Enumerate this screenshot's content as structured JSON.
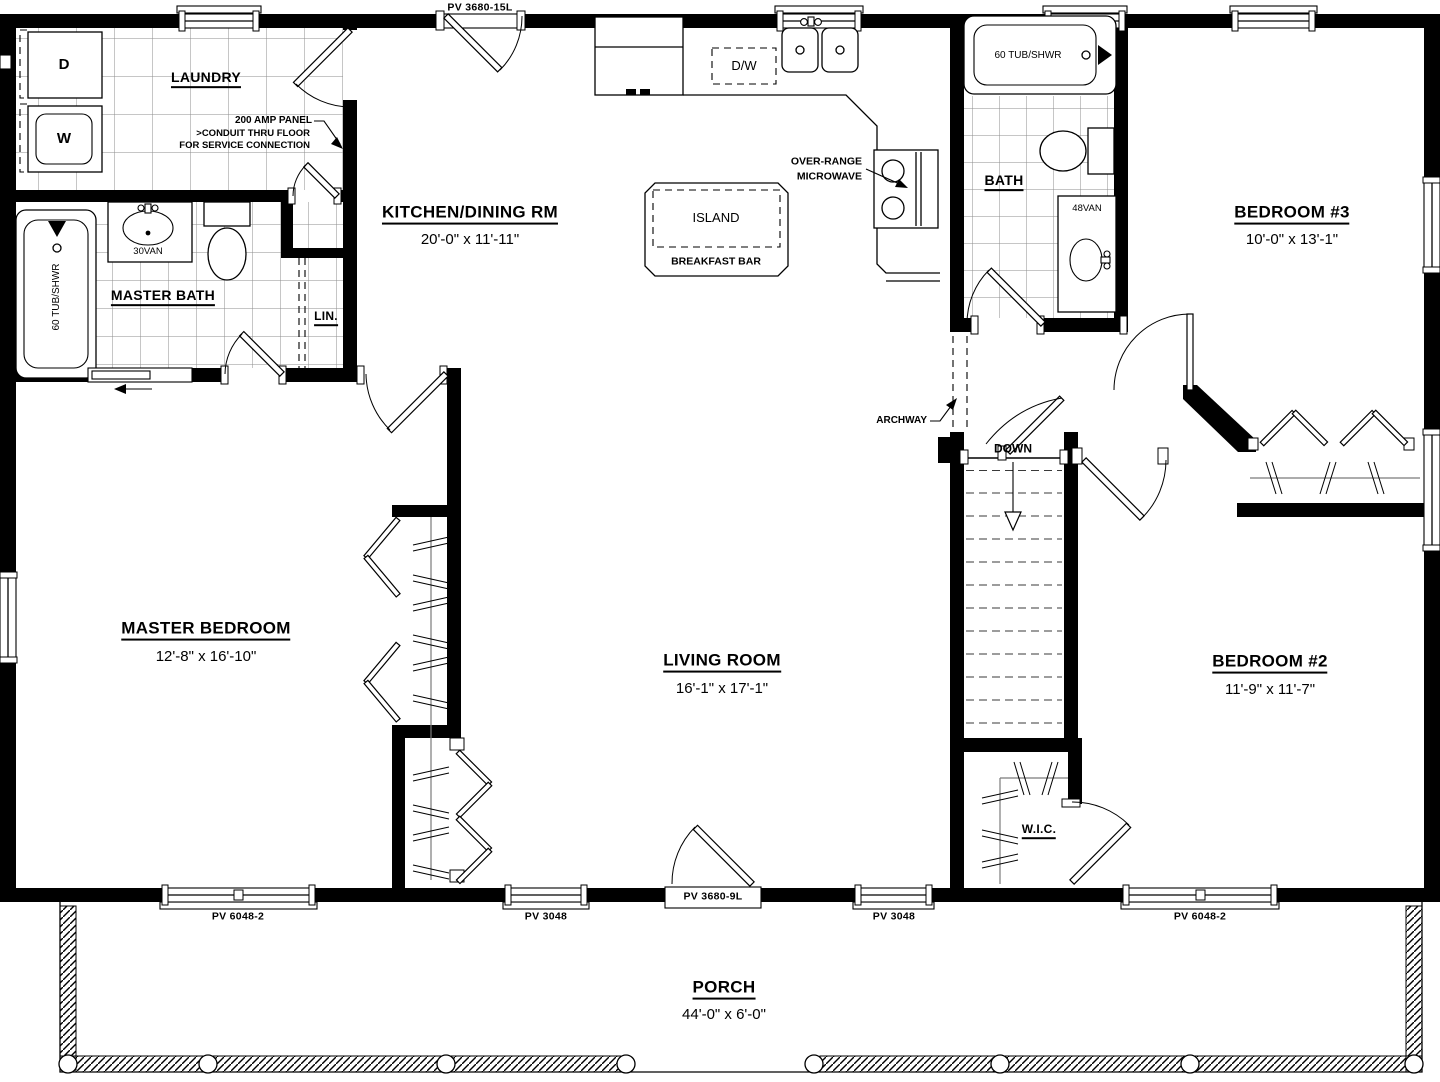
{
  "plan": {
    "rooms": {
      "laundry": {
        "name": "LAUNDRY"
      },
      "kitchen_dining": {
        "name": "KITCHEN/DINING RM",
        "dims": "20'-0\" x 11'-11\""
      },
      "master_bath": {
        "name": "MASTER BATH"
      },
      "linen": {
        "name": "LIN."
      },
      "bath": {
        "name": "BATH"
      },
      "bedroom3": {
        "name": "BEDROOM #3",
        "dims": "10'-0\" x 13'-1\""
      },
      "master_bedroom": {
        "name": "MASTER BEDROOM",
        "dims": "12'-8\" x 16'-10\""
      },
      "living_room": {
        "name": "LIVING ROOM",
        "dims": "16'-1\" x 17'-1\""
      },
      "bedroom2": {
        "name": "BEDROOM #2",
        "dims": "11'-9\" x 11'-7\""
      },
      "wic": {
        "name": "W.I.C."
      },
      "porch": {
        "name": "PORCH",
        "dims": "44'-0\" x 6'-0\""
      }
    },
    "fixtures": {
      "dryer": "D",
      "washer": "W",
      "dishwasher": "D/W",
      "island": "ISLAND",
      "breakfast_bar": "BREAKFAST BAR",
      "bath_tub": "60 TUB/SHWR",
      "master_tub": "60 TUB/SHWR",
      "vanity_30": "30VAN",
      "vanity_48": "48VAN"
    },
    "notes": {
      "microwave_line1": "OVER-RANGE",
      "microwave_line2": "MICROWAVE",
      "panel_line1": "200 AMP PANEL",
      "panel_line2": ">CONDUIT THRU FLOOR",
      "panel_line3": "FOR SERVICE CONNECTION",
      "archway": "ARCHWAY",
      "stairs_down": "DOWN"
    },
    "openings": {
      "rear_door": "PV 3680-15L",
      "front_door": "PV 3680-9L",
      "window_left_large": "PV 6048-2",
      "window_left_small": "PV 3048",
      "window_right_small": "PV 3048",
      "window_right_large": "PV 6048-2"
    }
  }
}
